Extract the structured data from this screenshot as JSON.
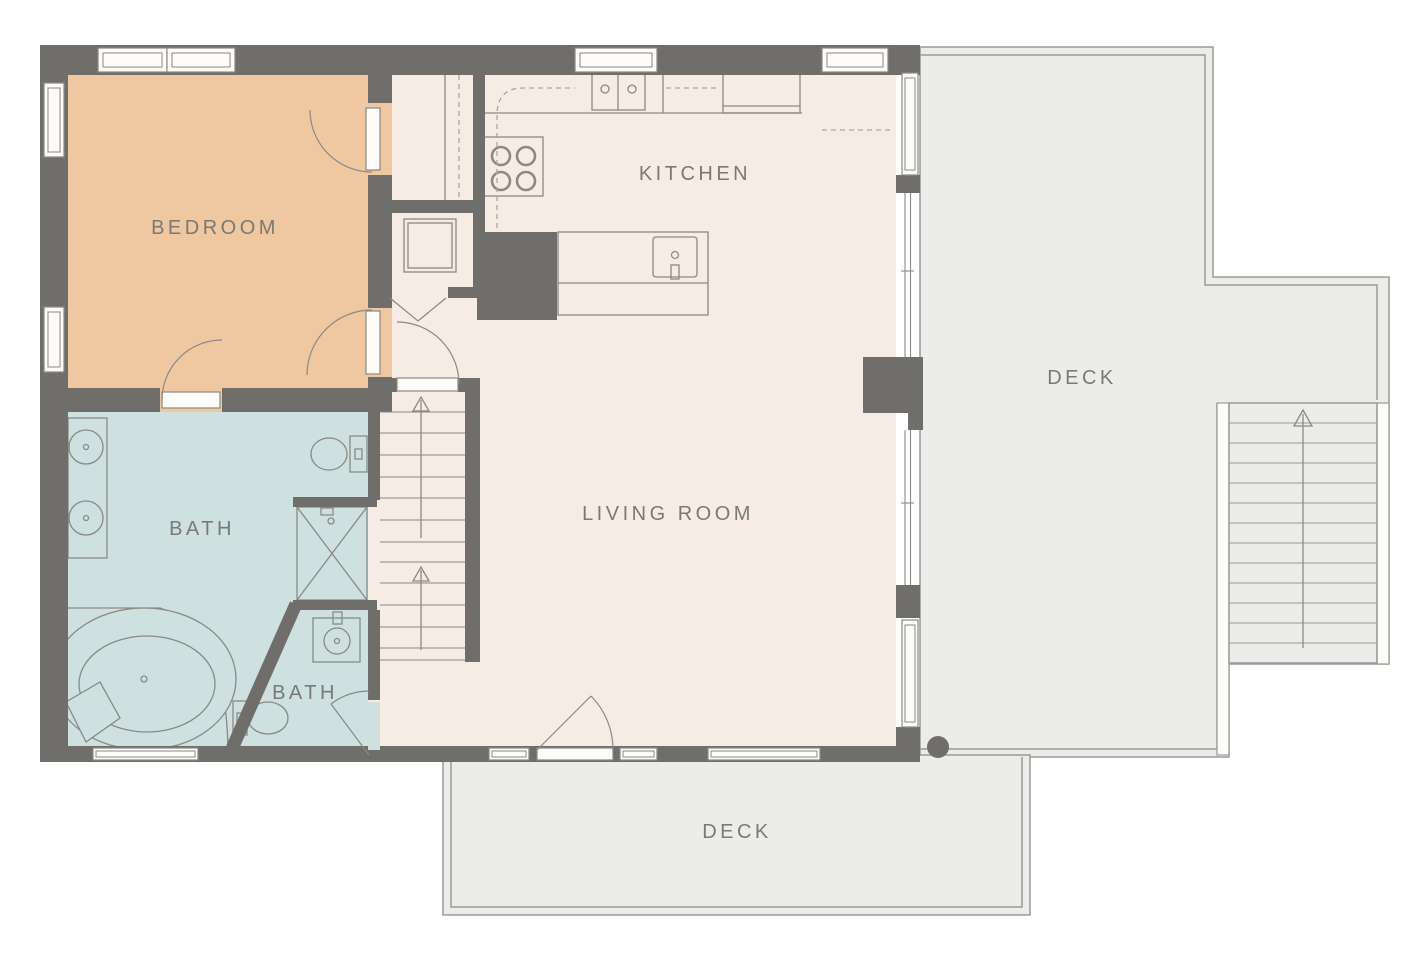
{
  "palette": {
    "wall": "#6f6e6a",
    "floor": "#f7ece3",
    "bedroom": "#efc8a1",
    "bath": "#cee0e0",
    "deck": "#ececeb",
    "deckBorder": "#9a9a96",
    "fixture": "#8a8984",
    "dash": "#a8a7a1",
    "window": "#fdfcf9",
    "label": "#7a7974",
    "background": "#ffffff"
  },
  "rooms": {
    "bedroom": {
      "label": "BEDROOM"
    },
    "kitchen": {
      "label": "KITCHEN"
    },
    "bath_main": {
      "label": "BATH"
    },
    "bath_small": {
      "label": "BATH"
    },
    "living_room": {
      "label": "LIVING ROOM"
    },
    "deck_right": {
      "label": "DECK"
    },
    "deck_bottom": {
      "label": "DECK"
    }
  },
  "icons": {
    "stairs_up_arrow": "open-triangle-up-with-shaft",
    "structural_column": "filled-circle"
  }
}
